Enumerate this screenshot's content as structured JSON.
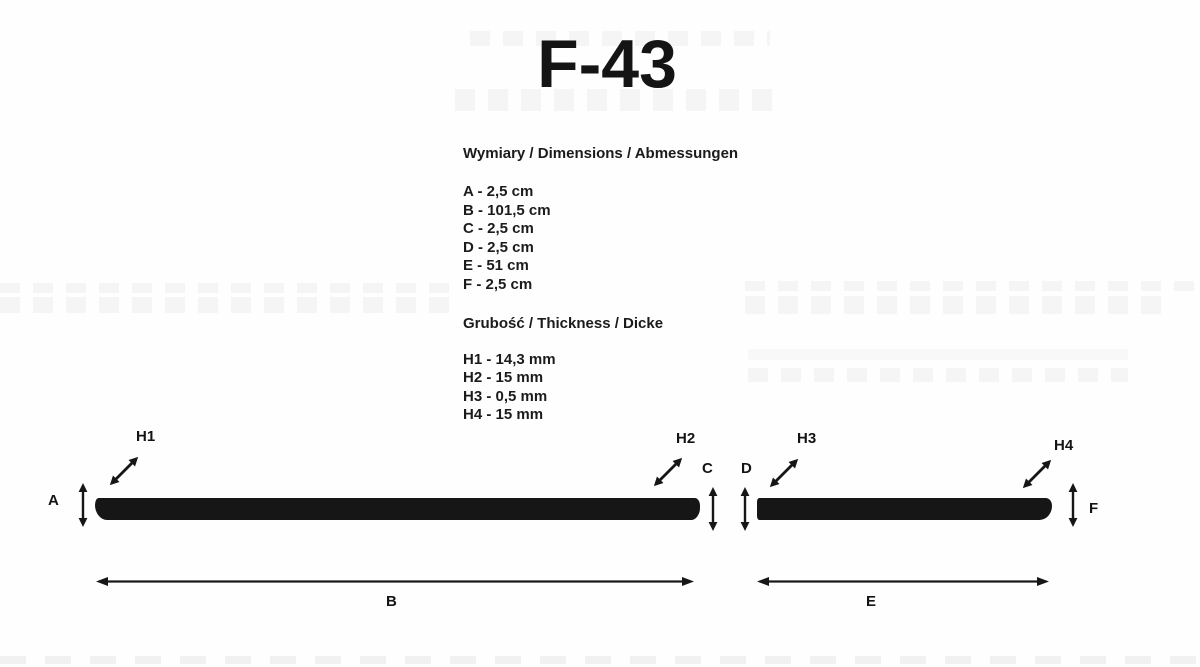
{
  "page": {
    "title": "F-43",
    "background": "#fefefe",
    "ink_color": "#161616"
  },
  "specs": {
    "dimensions": {
      "heading": "Wymiary / Dimensions / Abmessungen",
      "items": [
        "A - 2,5 cm",
        "B - 101,5 cm",
        "C - 2,5 cm",
        "D - 2,5 cm",
        "E - 51 cm",
        "F - 2,5 cm"
      ]
    },
    "thickness": {
      "heading": "Grubość / Thickness / Dicke",
      "items": [
        "H1 - 14,3 mm",
        "H2 - 15 mm",
        "H3 - 0,5 mm",
        "H4 - 15 mm"
      ]
    }
  },
  "diagram": {
    "strip_color": "#161616",
    "labels": {
      "a": "A",
      "b": "B",
      "c": "C",
      "d": "D",
      "e": "E",
      "f": "F",
      "h1": "H1",
      "h2": "H2",
      "h3": "H3",
      "h4": "H4"
    }
  }
}
